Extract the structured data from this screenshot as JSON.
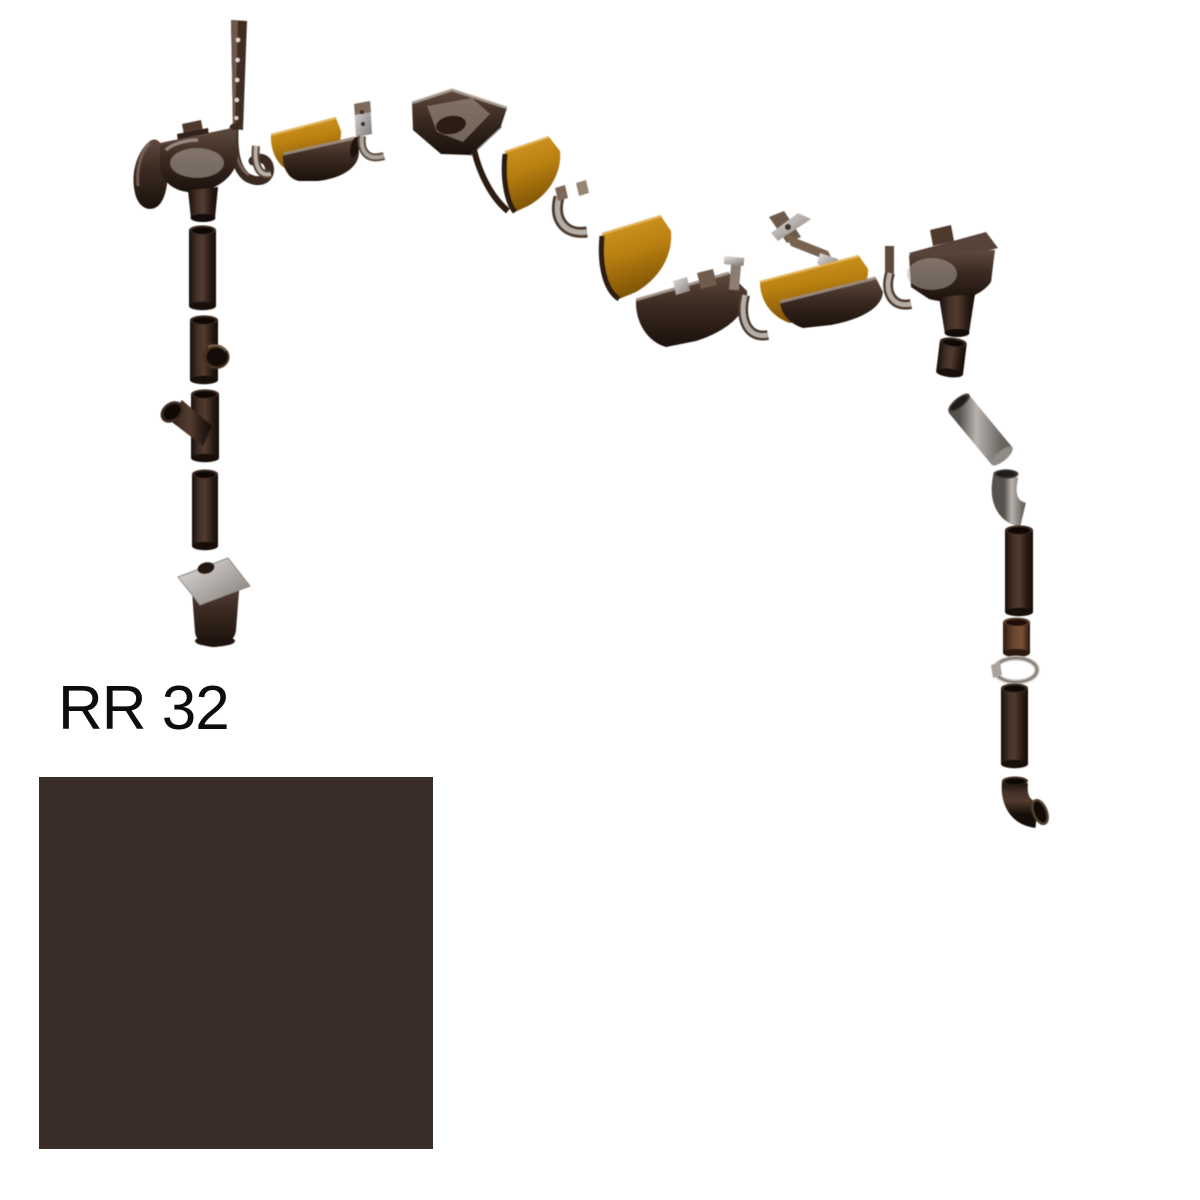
{
  "product": {
    "color_code": "RR 32",
    "swatch_color_hex": "#3a2c26"
  },
  "diagram": {
    "type": "product-exploded-view",
    "subject": "roof gutter and downpipe drainage system components in dark brown finish",
    "palette": {
      "part_dark_brown": "#3a2a21",
      "part_deep_shadow": "#140d09",
      "gutter_inner_amber": "#b97f10",
      "metal_silver": "#b5aea7",
      "pipe_gray": "#b7b2ae",
      "background": "#ffffff"
    },
    "parts": [
      "gutter-strap-hook",
      "gutter-end-cap",
      "gutter-outlet-funnel-left",
      "downpipe-section",
      "downpipe-tee",
      "downpipe-branch-45",
      "drain-trap",
      "gutter-hook",
      "gutter-bracket",
      "gutter-section",
      "gutter-corner",
      "gutter-union",
      "gutter-junction",
      "adjustable-bracket",
      "gutter-outlet-funnel-right",
      "downpipe-angled",
      "downpipe-elbow",
      "pipe-coupling",
      "pipe-clamp",
      "downpipe-shoe"
    ]
  }
}
